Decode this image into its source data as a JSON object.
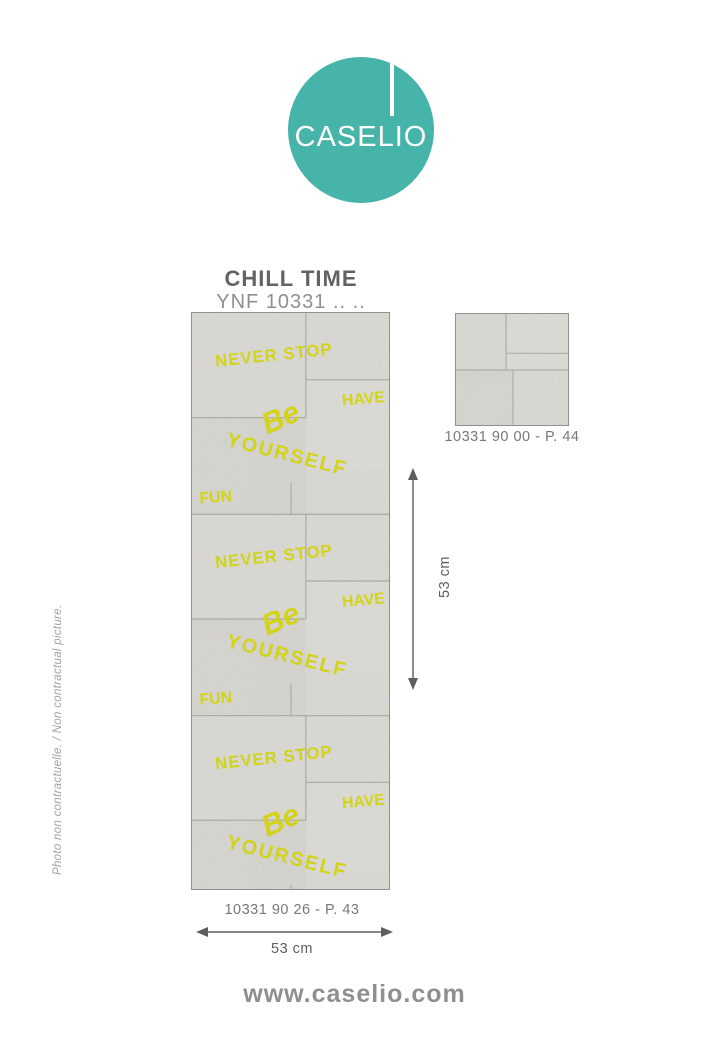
{
  "logo": {
    "brand": "CASELIO",
    "color": "#47b4aa"
  },
  "header": {
    "title": "CHILL TIME",
    "reference": "YNF 10331 .. .."
  },
  "wallpaper": {
    "graffiti_words": {
      "never_stop": "NEVER STOP",
      "have": "HAVE",
      "be": "Be",
      "yourself": "YOURSELF",
      "fun": "FUN"
    },
    "graffiti_color": "#d3d317",
    "concrete_color": "#d9d8d3"
  },
  "samples": {
    "main": {
      "caption": "10331 90 26 - P. 43"
    },
    "plain": {
      "caption": "10331 90 00 - P. 44"
    }
  },
  "dimensions": {
    "vertical_label": "53 cm",
    "horizontal_label": "53 cm"
  },
  "side_note": {
    "text": "Photo non contractuelle. / Non contractual picture."
  },
  "footer": {
    "url": "www.caselio.com"
  }
}
